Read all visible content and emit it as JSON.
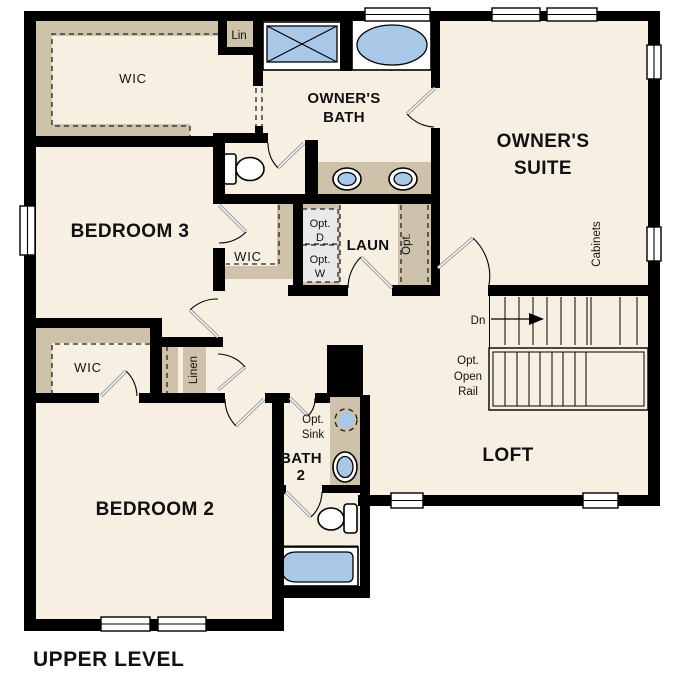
{
  "plan": {
    "title": "UPPER LEVEL",
    "labels": {
      "wic_owner": "WIC",
      "lin": "Lin",
      "owners_bath": [
        "OWNER'S",
        "BATH"
      ],
      "owners_suite": [
        "OWNER'S",
        "SUITE"
      ],
      "bedroom3": "BEDROOM 3",
      "wic_bedroom3": "WIC",
      "laun": "LAUN",
      "opt_dryer": [
        "Opt.",
        "D"
      ],
      "opt_washer": [
        "Opt.",
        "W"
      ],
      "opt_cabinets": [
        "Opt.",
        "Cabinets"
      ],
      "down": "Dn",
      "opt_open_rail": [
        "Opt.",
        "Open",
        "Rail"
      ],
      "loft": "LOFT",
      "wic_bedroom2": "WIC",
      "linen": "Linen",
      "opt_sink": [
        "Opt.",
        "Sink"
      ],
      "bath2": [
        "BATH",
        "2"
      ],
      "bedroom2": "BEDROOM 2"
    },
    "fixtures": [
      "shower",
      "soaking-tub",
      "double-vanity-sinks",
      "toilet",
      "optional-washer-dryer",
      "vanity-sink",
      "optional-sink",
      "bathtub",
      "stairs-down"
    ],
    "colors": {
      "wall": "#000000",
      "floor": "#f6efe2",
      "shelving": "#cfc2ab",
      "fixture_blue": "#a9c8e8",
      "optional_grey": "#e9e9e9"
    }
  }
}
